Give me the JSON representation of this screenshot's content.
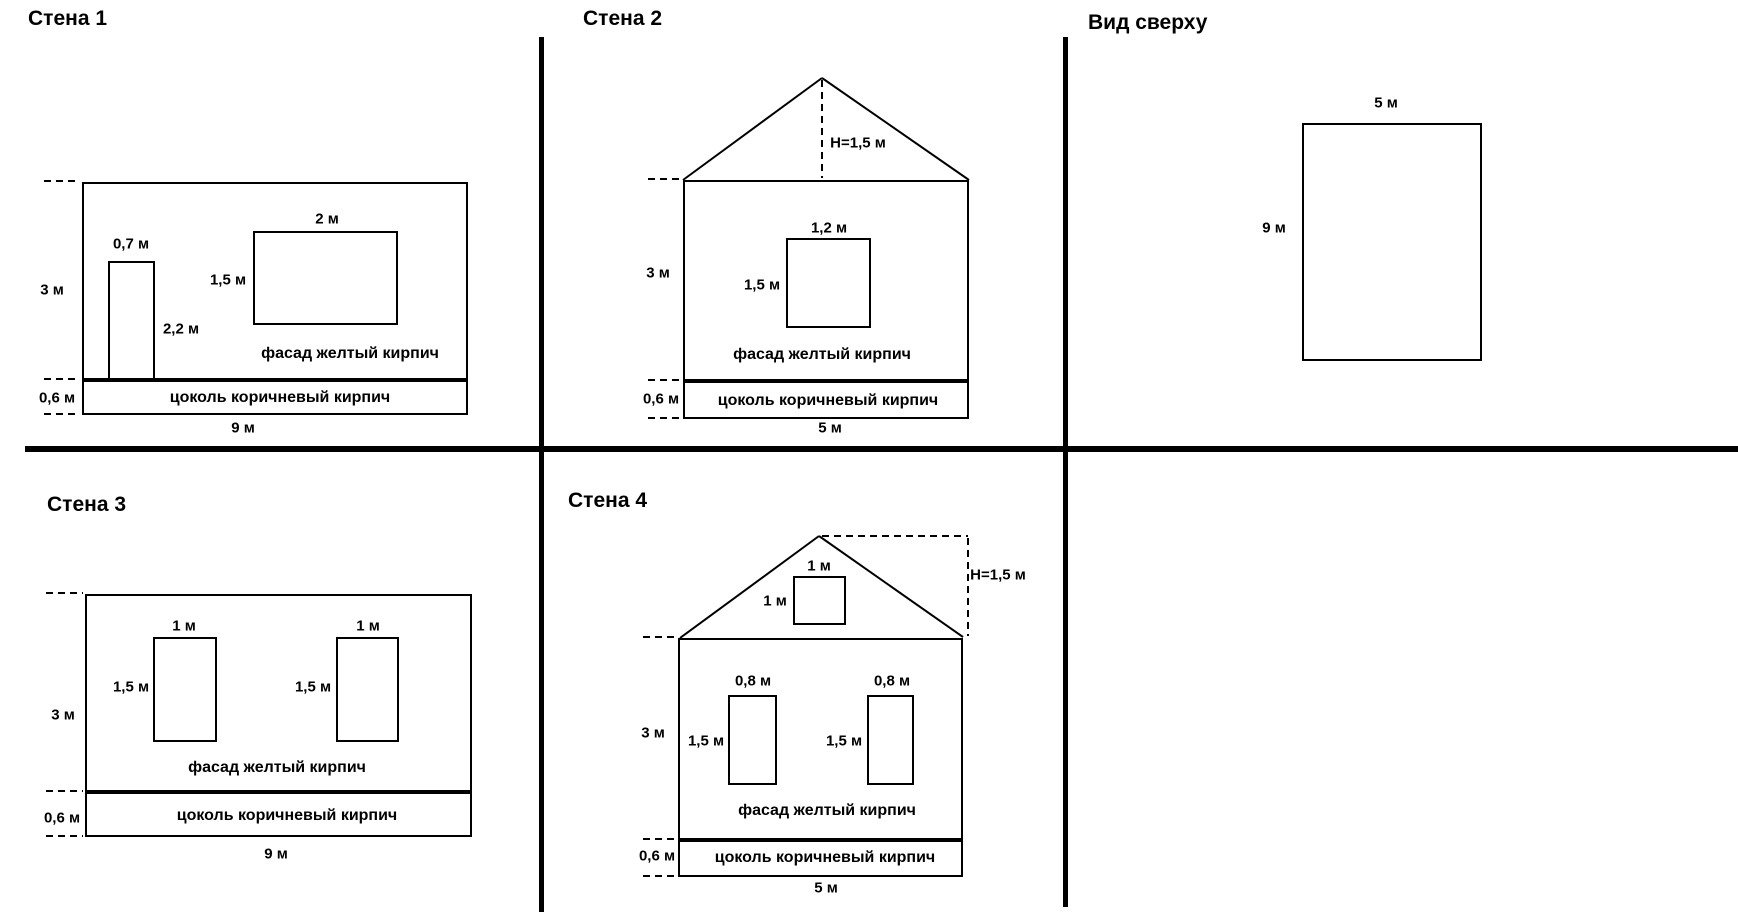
{
  "colors": {
    "background": "#ffffff",
    "line": "#000000"
  },
  "panels": {
    "wall1": {
      "title": "Стена 1",
      "wall_height": "3 м",
      "wall_width": "9 м",
      "plinth_height": "0,6 м",
      "facade": "фасад желтый кирпич",
      "plinth": "цоколь коричневый кирпич",
      "door": {
        "width": "0,7 м",
        "height": "2,2 м"
      },
      "window": {
        "width": "2 м",
        "height": "1,5 м"
      }
    },
    "wall2": {
      "title": "Стена 2",
      "roof_height": "H=1,5 м",
      "wall_height": "3 м",
      "wall_width": "5 м",
      "plinth_height": "0,6 м",
      "facade": "фасад желтый кирпич",
      "plinth": "цоколь коричневый кирпич",
      "window": {
        "width": "1,2 м",
        "height": "1,5 м"
      }
    },
    "top_view": {
      "title": "Вид сверху",
      "width": "5 м",
      "depth": "9 м"
    },
    "wall3": {
      "title": "Стена 3",
      "wall_height": "3 м",
      "wall_width": "9 м",
      "plinth_height": "0,6 м",
      "facade": "фасад желтый кирпич",
      "plinth": "цоколь коричневый кирпич",
      "window1": {
        "width": "1 м",
        "height": "1,5 м"
      },
      "window2": {
        "width": "1 м",
        "height": "1,5 м"
      }
    },
    "wall4": {
      "title": "Стена 4",
      "roof_height": "H=1,5 м",
      "attic_window": {
        "width": "1 м",
        "height": "1 м"
      },
      "wall_height": "3 м",
      "wall_width": "5 м",
      "plinth_height": "0,6 м",
      "facade": "фасад желтый кирпич",
      "plinth": "цоколь коричневый кирпич",
      "window1": {
        "width": "0,8 м",
        "height": "1,5 м"
      },
      "window2": {
        "width": "0,8 м",
        "height": "1,5 м"
      }
    }
  }
}
